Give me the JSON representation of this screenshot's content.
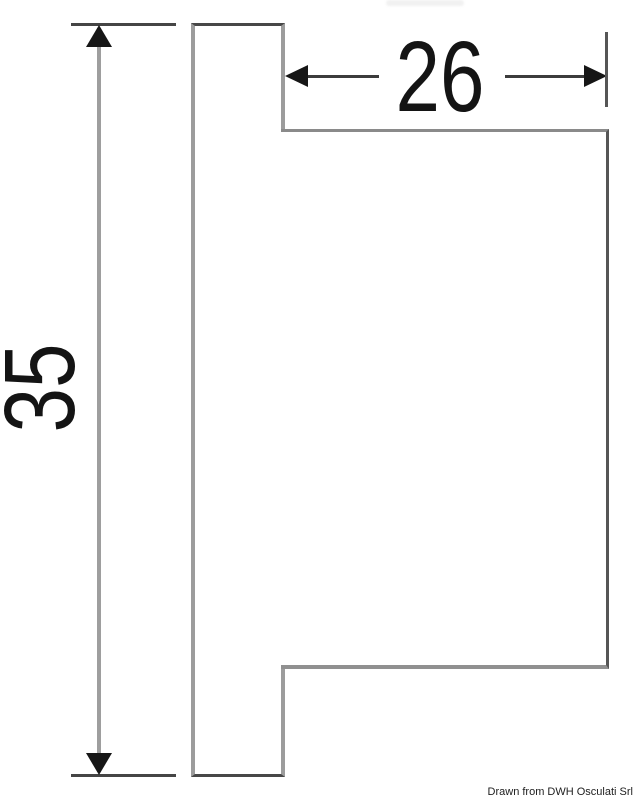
{
  "drawing": {
    "type": "technical-dimension-drawing",
    "credit": "Drawn from DWH Osculati Srl",
    "dimensions": [
      {
        "id": "height",
        "label": "35",
        "orientation": "vertical"
      },
      {
        "id": "width",
        "label": "26",
        "orientation": "horizontal"
      }
    ],
    "colors": {
      "background": "#ffffff",
      "outline_light_gray": "#9c9c9c",
      "outline_mid_gray": "#8a8a8a",
      "outline_dark_gray": "#474747",
      "dimension_line_light": "#9e9e9e",
      "dimension_line_dark": "#3c3c3c",
      "arrow_and_text": "#161616"
    }
  }
}
